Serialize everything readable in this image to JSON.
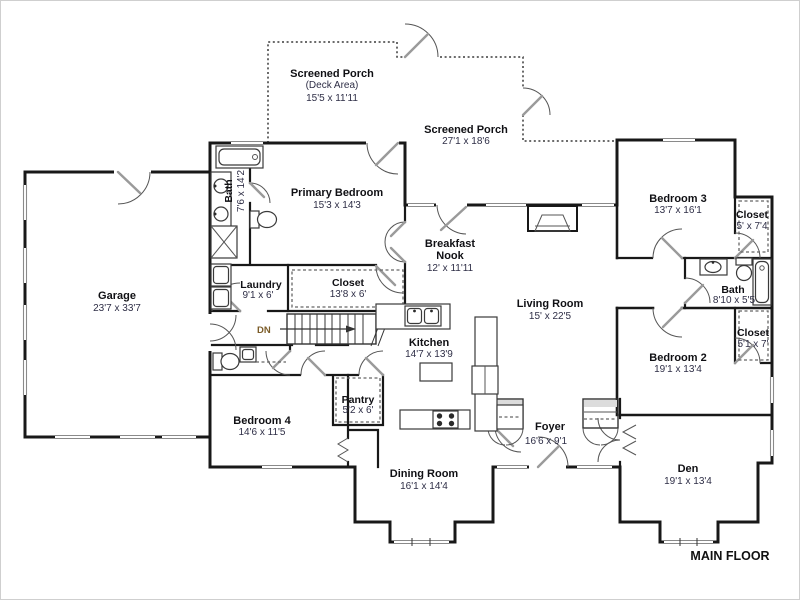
{
  "rooms": {
    "garage": {
      "name": "Garage",
      "dims": "23'7 x 33'7"
    },
    "screened_porch_deck": {
      "name": "Screened Porch",
      "sub": "(Deck Area)",
      "dims": "15'5 x 11'11"
    },
    "screened_porch": {
      "name": "Screened Porch",
      "dims": "27'1 x 18'6"
    },
    "primary_bedroom": {
      "name": "Primary Bedroom",
      "dims": "15'3 x 14'3"
    },
    "bath_primary": {
      "name": "Bath",
      "dims": "7'6 x 14'2"
    },
    "laundry": {
      "name": "Laundry",
      "dims": "9'1 x 6'"
    },
    "closet_primary": {
      "name": "Closet",
      "dims": "13'8 x 6'"
    },
    "breakfast_nook": {
      "name_line1": "Breakfast",
      "name_line2": "Nook",
      "dims": "12' x 11'11"
    },
    "living_room": {
      "name": "Living Room",
      "dims": "15' x 22'5"
    },
    "kitchen": {
      "name": "Kitchen",
      "dims": "14'7 x 13'9"
    },
    "pantry": {
      "name": "Pantry",
      "dims": "5'2 x 6'"
    },
    "bedroom4": {
      "name": "Bedroom 4",
      "dims": "14'6 x 11'5"
    },
    "dining_room": {
      "name": "Dining Room",
      "dims": "16'1 x 14'4"
    },
    "foyer": {
      "name": "Foyer",
      "dims": "16'6 x 9'1"
    },
    "den": {
      "name": "Den",
      "dims": "19'1 x 13'4"
    },
    "bedroom2": {
      "name": "Bedroom 2",
      "dims": "19'1 x 13'4"
    },
    "bedroom3": {
      "name": "Bedroom 3",
      "dims": "13'7 x 16'1"
    },
    "closet_bedroom3": {
      "name": "Closet",
      "dims": "5' x 7'4"
    },
    "bath_hall": {
      "name": "Bath",
      "dims": "8'10 x 5'5"
    },
    "closet_bedroom2": {
      "name": "Closet",
      "dims": "5'1 x 7'"
    }
  },
  "annotations": {
    "stairs_direction": "DN",
    "floor_label": "MAIN FLOOR"
  },
  "colors": {
    "wall": "#181818",
    "room_name": "#101014",
    "dimension": "#2e2e46",
    "porch_dash": "#3a3a3a",
    "window": "#8a8a8a"
  }
}
